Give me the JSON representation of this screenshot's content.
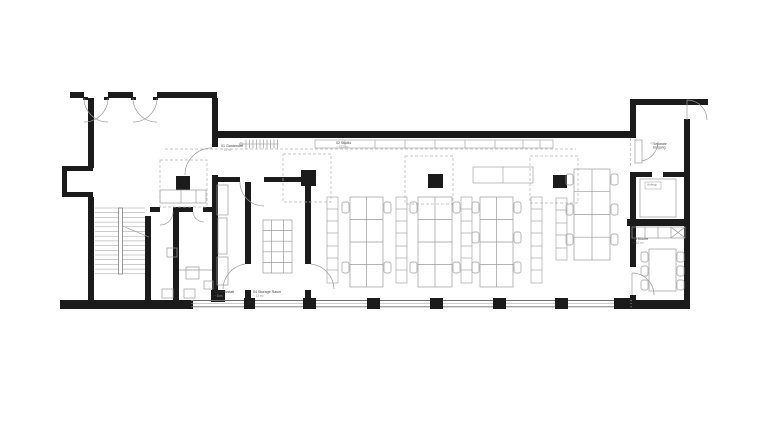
{
  "plan": {
    "rooms": [
      {
        "label": "01 Garderobe",
        "area": "~ 11 m²"
      },
      {
        "label": "02 Studio",
        "area": "~ 152 m²"
      },
      {
        "label": "03 Werkstatt",
        "area": "~ 8 m²"
      },
      {
        "label": "04 Storage Raum",
        "area": "~ 13 m²"
      },
      {
        "label": "05 Küche",
        "area": "~ 16 m²"
      }
    ],
    "annotations": {
      "entrance": {
        "arrow": "◁",
        "line1": "Separate",
        "line2": "Eingang"
      },
      "elevator": "Aufzug"
    },
    "colors": {
      "wall": "#1b1b1b",
      "furniture": "#9a9a9a",
      "dashed": "#b5b5b5",
      "background": "#ffffff"
    }
  }
}
